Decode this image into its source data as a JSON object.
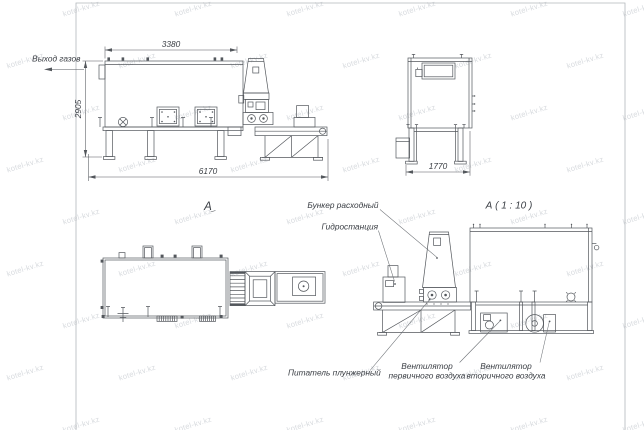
{
  "watermark": {
    "text": "kotel-kv.kz",
    "color": "#d7dade"
  },
  "colors": {
    "line": "#53575c",
    "text": "#3a3e44",
    "watermark": "#d7dade",
    "background": "#ffffff"
  },
  "labels": {
    "gas_outlet": "Выход газов",
    "view_a_title": "А",
    "view_a_scale_title": "А ( 1 : 10 )",
    "feed_hopper": "Бункер расходный",
    "hydraulic_station": "Гидростанция",
    "plunger_feeder": "Питатель плунжерный",
    "primary_air_fan_line1": "Вентилятор",
    "primary_air_fan_line2": "первичного воздуха",
    "secondary_air_fan_line1": "Вентилятор",
    "secondary_air_fan_line2": "вторичного воздуха"
  },
  "dimensions": {
    "furnace_top_width_mm": "3380",
    "overall_height_mm": "2905",
    "overall_length_mm": "6170",
    "end_view_width_mm": "1770"
  }
}
